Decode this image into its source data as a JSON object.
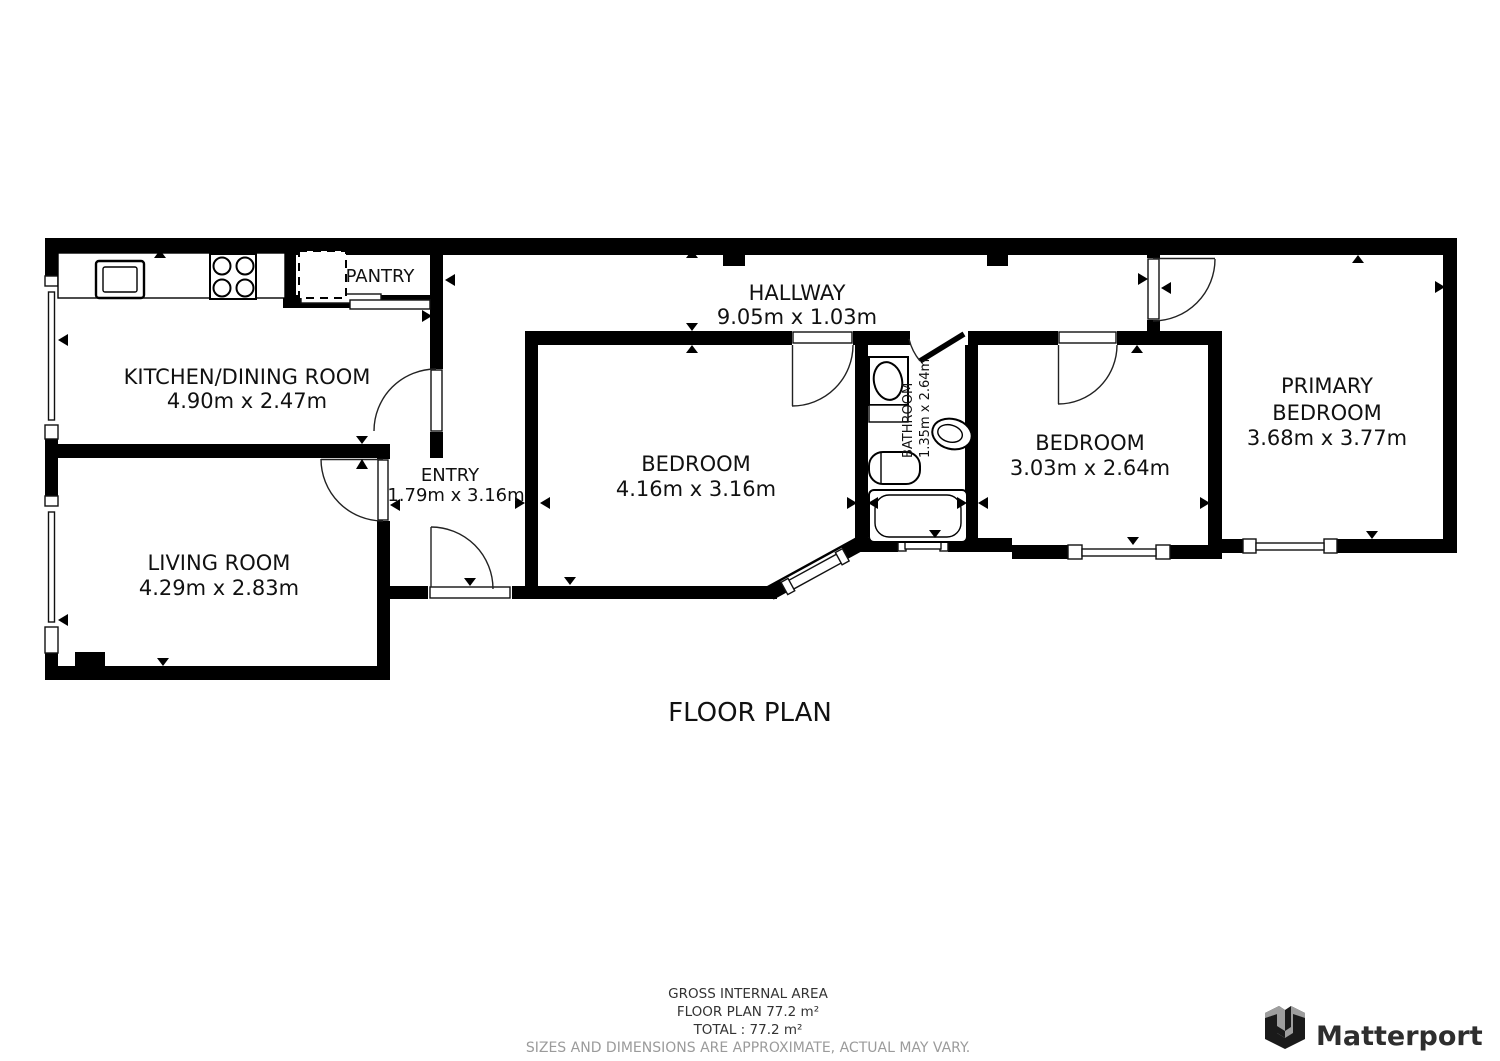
{
  "plan": {
    "title": "FLOOR PLAN",
    "rooms": {
      "kitchen": {
        "name": "KITCHEN/DINING ROOM",
        "dims": "4.90m x 2.47m"
      },
      "pantry": {
        "name": "PANTRY"
      },
      "hallway": {
        "name": "HALLWAY",
        "dims": "9.05m x 1.03m"
      },
      "entry": {
        "name": "ENTRY",
        "dims": "1.79m x 3.16m"
      },
      "living": {
        "name": "LIVING ROOM",
        "dims": "4.29m x 2.83m"
      },
      "bedroom1": {
        "name": "BEDROOM",
        "dims": "4.16m x 3.16m"
      },
      "bathroom": {
        "name": "BATHROOM",
        "dims": "1.35m x 2.64m"
      },
      "bedroom2": {
        "name": "BEDROOM",
        "dims": "3.03m x 2.64m"
      },
      "primary_bedroom": {
        "name_line1": "PRIMARY",
        "name_line2": "BEDROOM",
        "dims": "3.68m x 3.77m"
      }
    }
  },
  "footer": {
    "area_title": "GROSS INTERNAL AREA",
    "floor_plan_area": "FLOOR PLAN 77.2 m²",
    "total_area": "TOTAL :  77.2 m²",
    "disclaimer": "SIZES AND DIMENSIONS ARE APPROXIMATE, ACTUAL MAY VARY."
  },
  "brand": {
    "name": "Matterport"
  },
  "colors": {
    "wall": "#000000",
    "background": "#ffffff",
    "room_text": "#111111",
    "disclaimer_text": "#9b9b9b",
    "logo_text": "#2e2e2e",
    "logo_dark": "#1a1a1a",
    "logo_gray": "#9e9e9e"
  }
}
